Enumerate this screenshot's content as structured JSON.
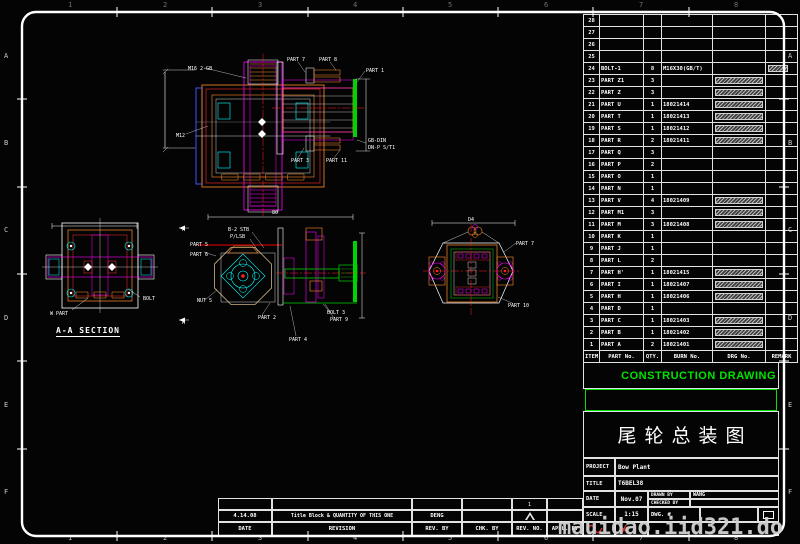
{
  "sheet": {
    "zone_letters": [
      "A",
      "B",
      "C",
      "D",
      "E",
      "F"
    ],
    "zone_numbers": [
      "1",
      "2",
      "3",
      "4",
      "5",
      "6",
      "7",
      "8"
    ]
  },
  "parts_table": {
    "headers": [
      "ITEM",
      "PART No.",
      "QTY.",
      "BURN No.",
      "DRG No.",
      "REMARK"
    ],
    "rows": [
      {
        "item": "28",
        "part": "",
        "qty": "",
        "burn": "",
        "drg_hatch": false,
        "remark_hatch": false
      },
      {
        "item": "27",
        "part": "",
        "qty": "",
        "burn": "",
        "drg_hatch": false,
        "remark_hatch": false
      },
      {
        "item": "26",
        "part": "",
        "qty": "",
        "burn": "",
        "drg_hatch": false,
        "remark_hatch": false
      },
      {
        "item": "25",
        "part": "",
        "qty": "",
        "burn": "",
        "drg_hatch": false,
        "remark_hatch": false
      },
      {
        "item": "24",
        "part": "BOLT-1",
        "qty": "8",
        "burn": "M16X30(GB/T)",
        "drg_hatch": false,
        "remark_hatch": true
      },
      {
        "item": "23",
        "part": "PART Z1",
        "qty": "3",
        "burn": "",
        "drg_hatch": true,
        "remark_hatch": false
      },
      {
        "item": "22",
        "part": "PART Z",
        "qty": "3",
        "burn": "",
        "drg_hatch": true,
        "remark_hatch": false
      },
      {
        "item": "21",
        "part": "PART U",
        "qty": "1",
        "burn": "18021414",
        "drg_hatch": true,
        "remark_hatch": false
      },
      {
        "item": "20",
        "part": "PART T",
        "qty": "1",
        "burn": "18021413",
        "drg_hatch": true,
        "remark_hatch": false
      },
      {
        "item": "19",
        "part": "PART S",
        "qty": "1",
        "burn": "18021412",
        "drg_hatch": true,
        "remark_hatch": false
      },
      {
        "item": "18",
        "part": "PART R",
        "qty": "2",
        "burn": "18021411",
        "drg_hatch": true,
        "remark_hatch": false
      },
      {
        "item": "17",
        "part": "PART Q",
        "qty": "3",
        "burn": "",
        "drg_hatch": false,
        "remark_hatch": false
      },
      {
        "item": "16",
        "part": "PART P",
        "qty": "2",
        "burn": "",
        "drg_hatch": false,
        "remark_hatch": false
      },
      {
        "item": "15",
        "part": "PART O",
        "qty": "1",
        "burn": "",
        "drg_hatch": false,
        "remark_hatch": false
      },
      {
        "item": "14",
        "part": "PART N",
        "qty": "1",
        "burn": "",
        "drg_hatch": false,
        "remark_hatch": false
      },
      {
        "item": "13",
        "part": "PART V",
        "qty": "4",
        "burn": "18021409",
        "drg_hatch": true,
        "remark_hatch": false
      },
      {
        "item": "12",
        "part": "PART M1",
        "qty": "3",
        "burn": "",
        "drg_hatch": true,
        "remark_hatch": false
      },
      {
        "item": "11",
        "part": "PART M",
        "qty": "3",
        "burn": "18021408",
        "drg_hatch": true,
        "remark_hatch": false
      },
      {
        "item": "10",
        "part": "PART K",
        "qty": "1",
        "burn": "",
        "drg_hatch": false,
        "remark_hatch": false
      },
      {
        "item": "9",
        "part": "PART J",
        "qty": "1",
        "burn": "",
        "drg_hatch": false,
        "remark_hatch": false
      },
      {
        "item": "8",
        "part": "PART L",
        "qty": "2",
        "burn": "",
        "drg_hatch": false,
        "remark_hatch": false
      },
      {
        "item": "7",
        "part": "PART H'",
        "qty": "1",
        "burn": "18021415",
        "drg_hatch": true,
        "remark_hatch": false
      },
      {
        "item": "6",
        "part": "PART I",
        "qty": "1",
        "burn": "18021407",
        "drg_hatch": true,
        "remark_hatch": false
      },
      {
        "item": "5",
        "part": "PART H",
        "qty": "1",
        "burn": "18021406",
        "drg_hatch": true,
        "remark_hatch": false
      },
      {
        "item": "4",
        "part": "PART D",
        "qty": "1",
        "burn": "",
        "drg_hatch": false,
        "remark_hatch": false
      },
      {
        "item": "3",
        "part": "PART C",
        "qty": "1",
        "burn": "18021403",
        "drg_hatch": true,
        "remark_hatch": false
      },
      {
        "item": "2",
        "part": "PART B",
        "qty": "1",
        "burn": "18021402",
        "drg_hatch": true,
        "remark_hatch": false
      },
      {
        "item": "1",
        "part": "PART A",
        "qty": "2",
        "burn": "18021401",
        "drg_hatch": true,
        "remark_hatch": false
      }
    ]
  },
  "stamp": {
    "construction_drawing": "CONSTRUCTION DRAWING"
  },
  "title_block": {
    "drawing_title": "尾轮总装图",
    "project_label": "PROJECT",
    "project_value": "Bow Plant",
    "title_label": "TITLE",
    "title_value": "T6BEL38",
    "date_label": "DATE",
    "date_value": "Nov.07",
    "drawn_by_label": "DRAWN BY",
    "drawn_by_value": "WANG",
    "checked_by_label": "CHECKED BY",
    "checked_by_value": "",
    "scale_label": "SCALE",
    "scale_value": "1:15",
    "dwg_no_label": "DWG. #",
    "dwg_no_value": ""
  },
  "revision_strip": {
    "headers": [
      "DATE",
      "REVISION",
      "REV. BY",
      "CHK. BY",
      "REV. NO.",
      "APPL. BY"
    ],
    "entry": {
      "date": "4.14.08",
      "revision": "Title Block & QUANTITY OF THIS ONE",
      "rev_by": "DENG",
      "chk_by": "",
      "rev_no": "1",
      "appl_by": ""
    }
  },
  "views": {
    "section_label": "A-A SECTION"
  },
  "drawing_labels": [
    {
      "x": 188,
      "y": 70,
      "t": "M16 2-GB"
    },
    {
      "x": 176,
      "y": 137,
      "t": "M12"
    },
    {
      "x": 287,
      "y": 61,
      "t": "PART 7"
    },
    {
      "x": 319,
      "y": 61,
      "t": "PART 8"
    },
    {
      "x": 366,
      "y": 72,
      "t": "PART 1"
    },
    {
      "x": 368,
      "y": 142,
      "t": "GB-DIN"
    },
    {
      "x": 368,
      "y": 149,
      "t": "DN-P S/T1"
    },
    {
      "x": 291,
      "y": 162,
      "t": "PART 3"
    },
    {
      "x": 326,
      "y": 162,
      "t": "PART 11"
    },
    {
      "x": 50,
      "y": 315,
      "t": "W PART"
    },
    {
      "x": 143,
      "y": 300,
      "t": "BOLT"
    },
    {
      "x": 228,
      "y": 231,
      "t": "B-2 STB"
    },
    {
      "x": 230,
      "y": 238,
      "t": "P/LSB"
    },
    {
      "x": 190,
      "y": 246,
      "t": "PART 5"
    },
    {
      "x": 190,
      "y": 256,
      "t": "PART 6"
    },
    {
      "x": 197,
      "y": 302,
      "t": "NUT 5"
    },
    {
      "x": 258,
      "y": 319,
      "t": "PART 2"
    },
    {
      "x": 289,
      "y": 341,
      "t": "PART 4"
    },
    {
      "x": 327,
      "y": 314,
      "t": "BOLT 3"
    },
    {
      "x": 330,
      "y": 321,
      "t": "PART 9"
    },
    {
      "x": 516,
      "y": 245,
      "t": "PART 7"
    },
    {
      "x": 508,
      "y": 307,
      "t": "PART 10"
    },
    {
      "x": 182,
      "y": 231,
      "t": "A"
    },
    {
      "x": 182,
      "y": 324,
      "t": "A"
    },
    {
      "x": 272,
      "y": 214,
      "t": "80"
    },
    {
      "x": 468,
      "y": 221,
      "t": "D4"
    }
  ],
  "watermark": "mauidao.iid321.do",
  "colors": {
    "accent_green": "#00e400",
    "line_red": "#ff2020",
    "line_magenta": "#ff00ff",
    "line_cyan": "#00ffff",
    "line_orange": "#ff8c2a",
    "line_tan": "#cdb380",
    "frame_white": "#ffffff"
  }
}
